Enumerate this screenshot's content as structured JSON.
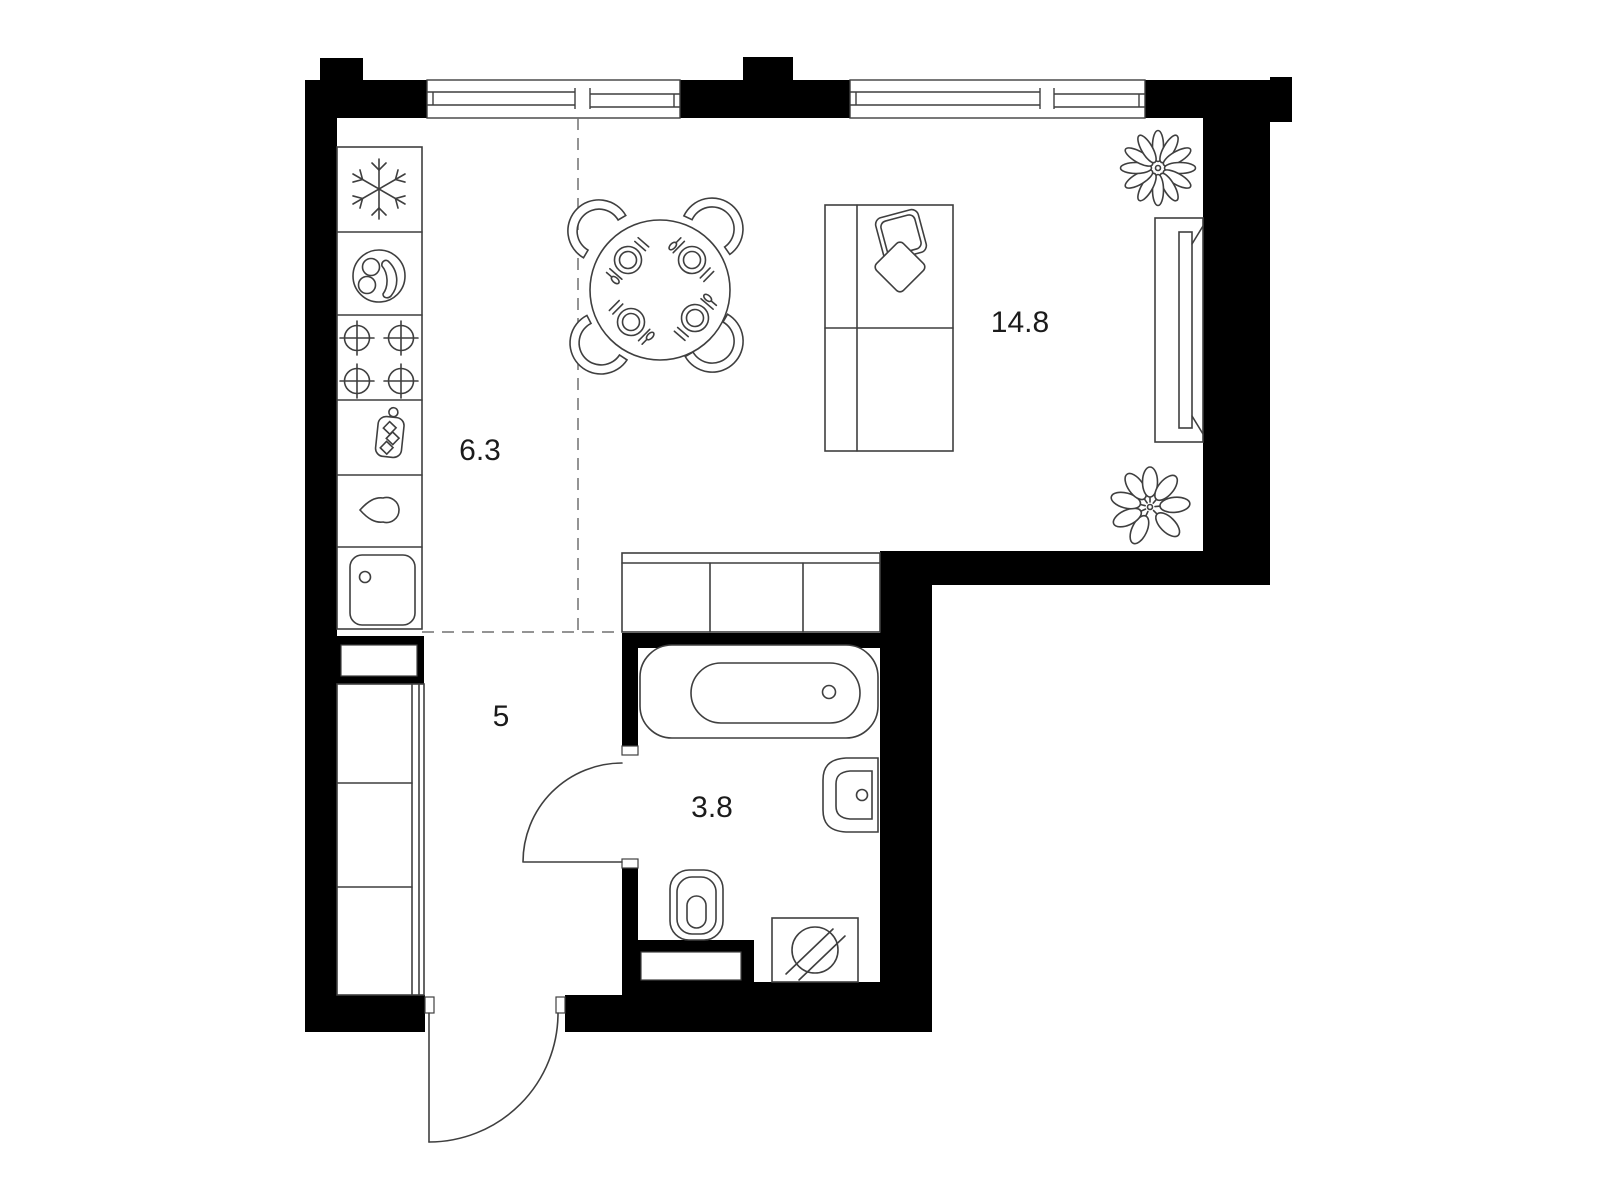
{
  "colors": {
    "background": "#ffffff",
    "wall": "#000000",
    "line": "#3f3f3f",
    "dashed_line": "#707070",
    "label": "#1b1b1b"
  },
  "rooms": [
    {
      "name": "kitchen-zone",
      "area_label": "6.3"
    },
    {
      "name": "living-room",
      "area_label": "14.8"
    },
    {
      "name": "hallway",
      "area_label": "5"
    },
    {
      "name": "bathroom",
      "area_label": "3.8"
    }
  ],
  "fixtures": {
    "kitchen": [
      "fridge-freezer-icon",
      "serving-plate-icon",
      "hob-4-burner-icon",
      "cutting-board-icon",
      "extractor-drop-icon",
      "kitchen-sink-icon"
    ],
    "dining": [
      "round-dining-table",
      "chair",
      "chair",
      "chair",
      "chair",
      "place-setting",
      "place-setting",
      "place-setting",
      "place-setting"
    ],
    "living": [
      "sofa-two-seat",
      "pillow",
      "pillow",
      "tv-console",
      "flower-plant-icon",
      "leafy-plant-icon",
      "storage-cabinet-row"
    ],
    "hallway": [
      "wardrobe",
      "duct-shaft"
    ],
    "bathroom": [
      "bathtub",
      "washbasin",
      "toilet",
      "washing-machine-icon",
      "duct-shaft"
    ]
  },
  "openings": {
    "windows": 2,
    "doors": [
      "entrance-door",
      "bathroom-door"
    ]
  }
}
